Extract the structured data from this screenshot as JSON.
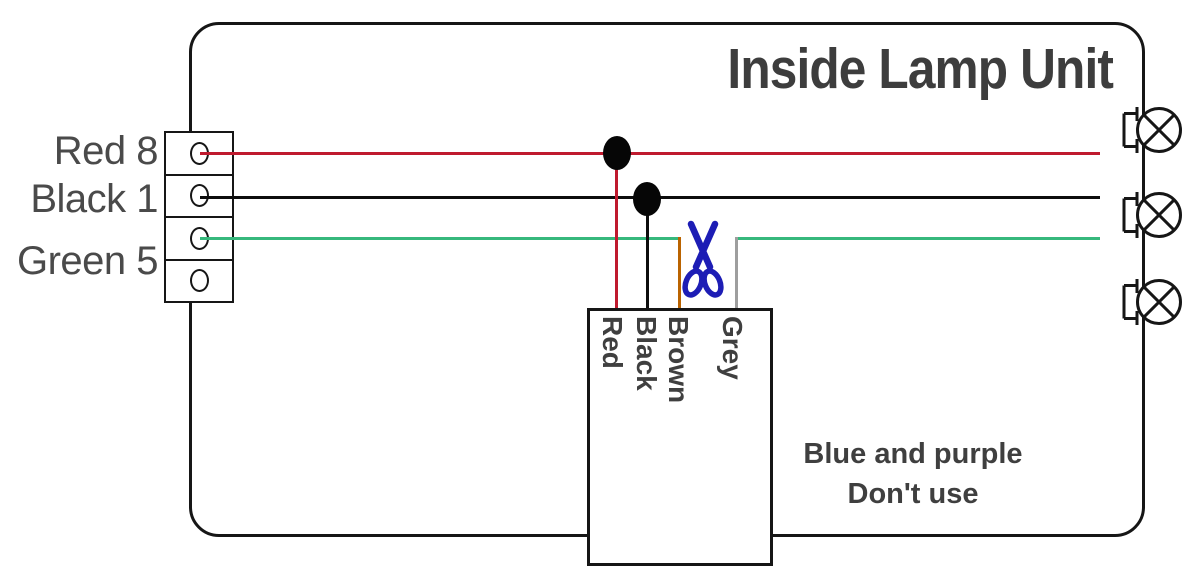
{
  "title": "Inside Lamp Unit",
  "connector": {
    "labels": [
      "Red 8",
      "Black 1",
      "Green 5"
    ],
    "terminal_count": 4
  },
  "wires": {
    "red": {
      "name": "red",
      "hex": "#bf1a2e"
    },
    "black": {
      "name": "black",
      "hex": "#0d0d0d"
    },
    "green": {
      "name": "green",
      "hex": "#36b87c"
    },
    "brown": {
      "name": "brown",
      "hex": "#ba6300"
    },
    "grey": {
      "name": "grey",
      "hex": "#9e9e9e"
    }
  },
  "junction_box": {
    "wire_labels": [
      "Red",
      "Black",
      "Brown",
      "Grey"
    ]
  },
  "note": {
    "line1": "Blue and purple",
    "line2": "Don't use"
  },
  "lamps": {
    "count": 3
  },
  "icons": {
    "scissors": "scissors-cut-icon",
    "lamp": "lamp-circle-x-icon",
    "terminal_hole": "terminal-hole-icon"
  },
  "palette": {
    "outline": "#161616",
    "title_text": "#3d3d3d",
    "label_text": "#4a4a4a",
    "scissors_blue": "#1d1db5"
  }
}
